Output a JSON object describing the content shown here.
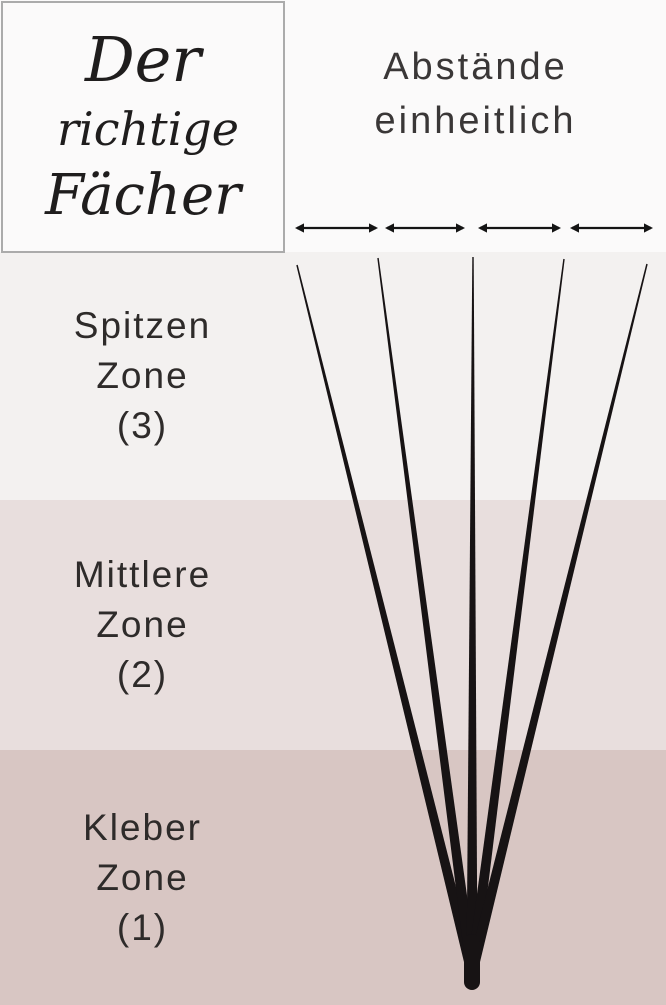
{
  "logo": {
    "line1": "Der",
    "line2": "richtige",
    "line3": "Fächer"
  },
  "header": {
    "line1": "Abstände",
    "line2": "einheitlich"
  },
  "zones": {
    "spitzen": {
      "line1": "Spitzen",
      "line2": "Zone",
      "line3": "(3)",
      "bg": "#f3f1f0"
    },
    "mittlere": {
      "line1": "Mittlere",
      "line2": "Zone",
      "line3": "(2)",
      "bg": "#e8dedd"
    },
    "kleber": {
      "line1": "Kleber",
      "line2": "Zone",
      "line3": "(1)",
      "bg": "#d8c6c3"
    }
  },
  "top_band_bg": "#fbfafa",
  "arrows": {
    "color": "#141414",
    "y": 228,
    "stroke_width": 2.3,
    "head_length": 9,
    "head_half_width": 4.6,
    "segments": [
      [
        295,
        378
      ],
      [
        385,
        465
      ],
      [
        478,
        561
      ],
      [
        570,
        653
      ]
    ]
  },
  "fan": {
    "color": "#171314",
    "converge_x": 472,
    "converge_y": 972,
    "tip_half_width": 0.7,
    "base_half_width": 5.5,
    "tips": [
      {
        "x": 297,
        "y": 265
      },
      {
        "x": 378,
        "y": 258
      },
      {
        "x": 473,
        "y": 257
      },
      {
        "x": 564,
        "y": 259
      },
      {
        "x": 647,
        "y": 264
      }
    ],
    "stem": {
      "x": 472,
      "y1": 942,
      "y2": 982,
      "width": 16
    }
  }
}
